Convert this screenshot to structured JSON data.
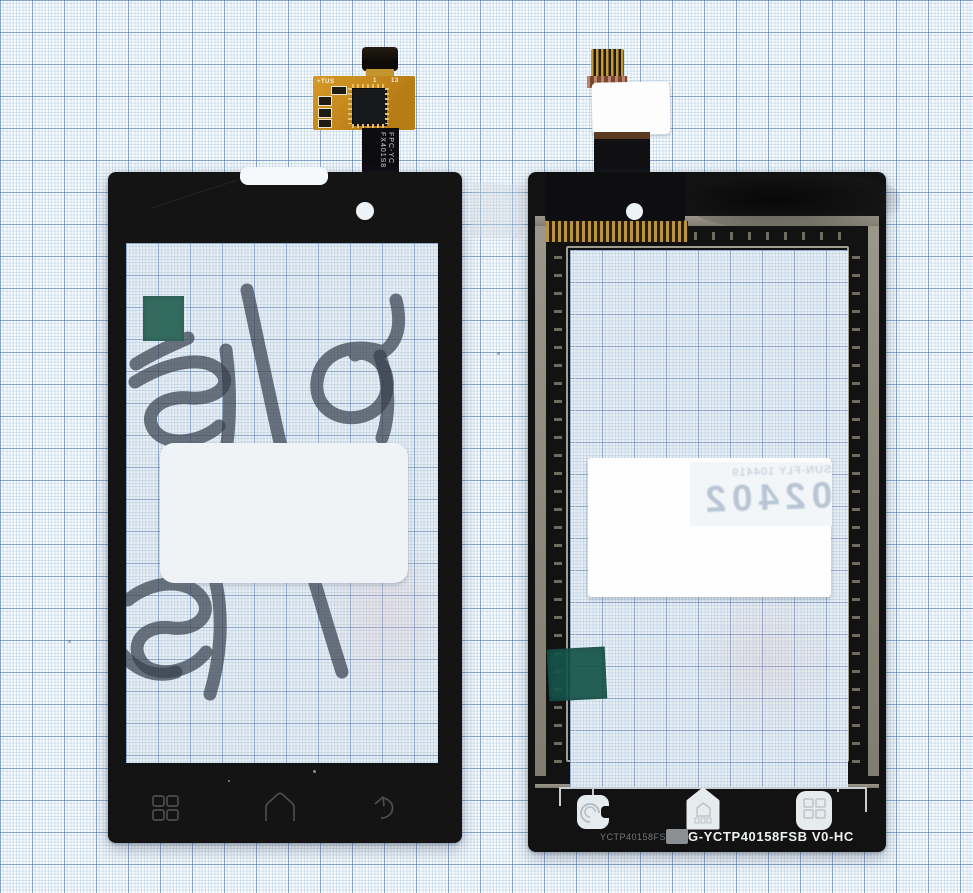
{
  "scene": {
    "description": "Two smartphone touchscreen digitizer panels (front view left, back view right) photographed on blue millimeter graph paper",
    "background": {
      "paper_color": "#f8fbfd",
      "fine_line_color": "#80acd4",
      "bold_line_color": "#3e6ca8"
    }
  },
  "left_panel": {
    "kind": "digitizer front glass",
    "bezel_color": "#141414",
    "flex": {
      "pcb_color": "#c8861e",
      "silkscreen_mark": "+TUS",
      "pin_label_first": "1",
      "pin_label_last": "13",
      "ribbon_text_line1": "FPC-YC",
      "ribbon_text_line2": "FX401S8"
    },
    "stickers": {
      "green_square_color": "#1d5c4a",
      "white_label": ""
    },
    "handwriting_text": "78.11.18",
    "nav_icons": [
      {
        "name": "menu",
        "style": "four-squares outline"
      },
      {
        "name": "home",
        "style": "house outline"
      },
      {
        "name": "back",
        "style": "curved arrow outline"
      }
    ]
  },
  "right_panel": {
    "kind": "digitizer back side",
    "bezel_color": "#121212",
    "frame_color": "#8f8b7f",
    "bottom_text_faint": "YCTP40158FS-C5",
    "bottom_text_bold": "G-YCTP40158FSB V0-HC",
    "sticker_text_small_mirrored": "SUN-FLY 104419",
    "sticker_text_big_mirrored": "02402",
    "nav_pads": [
      {
        "name": "back",
        "style": "white pad with swirl"
      },
      {
        "name": "home",
        "style": "white house pad"
      },
      {
        "name": "menu",
        "style": "white pad with 2x2 squares"
      }
    ]
  }
}
